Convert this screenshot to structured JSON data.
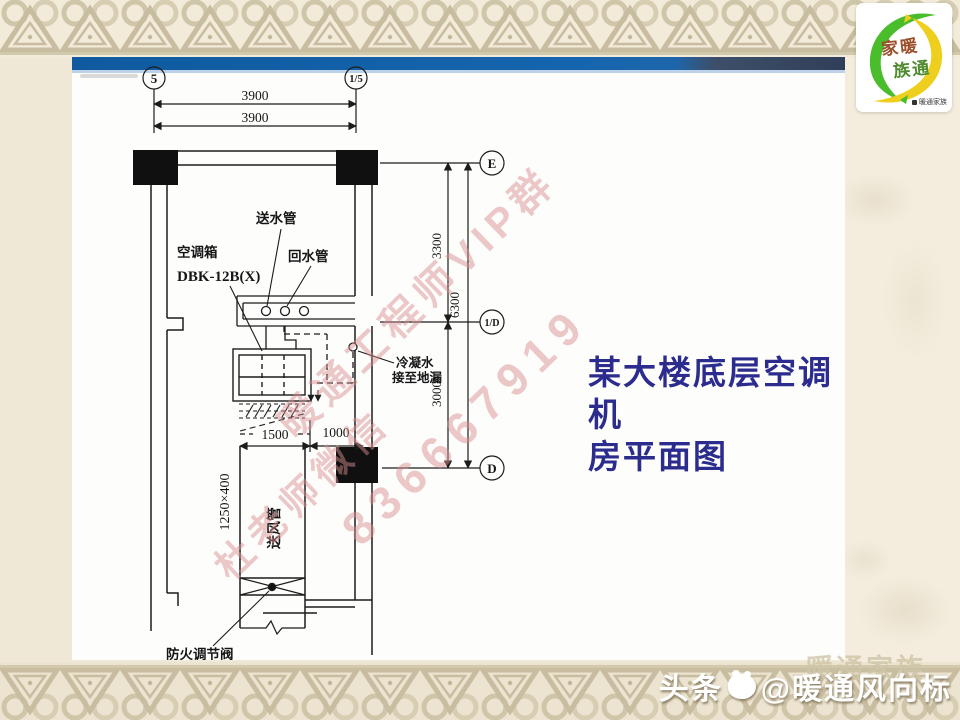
{
  "title": {
    "line1": "某大楼底层空调机",
    "line2": "房平面图",
    "color": "#2c2c8e"
  },
  "logo": {
    "name_line1": "家暖",
    "name_line2": "族通",
    "tagline": "暖通家族"
  },
  "watermark": {
    "line1": "暖通工程师VIP群",
    "line2": "836667919",
    "line3": "杜老师微信",
    "color": "#d98f8f"
  },
  "footer": {
    "prefix": "头条",
    "handle": "@暖通风向标",
    "ghost": "暖通家族"
  },
  "drawing": {
    "grid": {
      "col_a": "5",
      "col_b": "1/5",
      "row_e": "E",
      "row_d1": "1/D",
      "row_d": "D"
    },
    "dims": {
      "span_top": "3900",
      "span_top2": "3900",
      "seg_upper": "3300",
      "total": "6300",
      "seg_lower": "3000",
      "duct_len": "1500",
      "gap": "1000",
      "duct_size": "1250×400"
    },
    "labels": {
      "supply_pipe": "送水管",
      "return_pipe": "回水管",
      "ahu_1": "空调箱",
      "ahu_2": "DBK-12B(X)",
      "cond_1": "冷凝水",
      "cond_2": "接至地漏",
      "duct": "送风管",
      "damper": "防火调节阀"
    },
    "caption_note": "某大楼底层空调机房平面图"
  }
}
